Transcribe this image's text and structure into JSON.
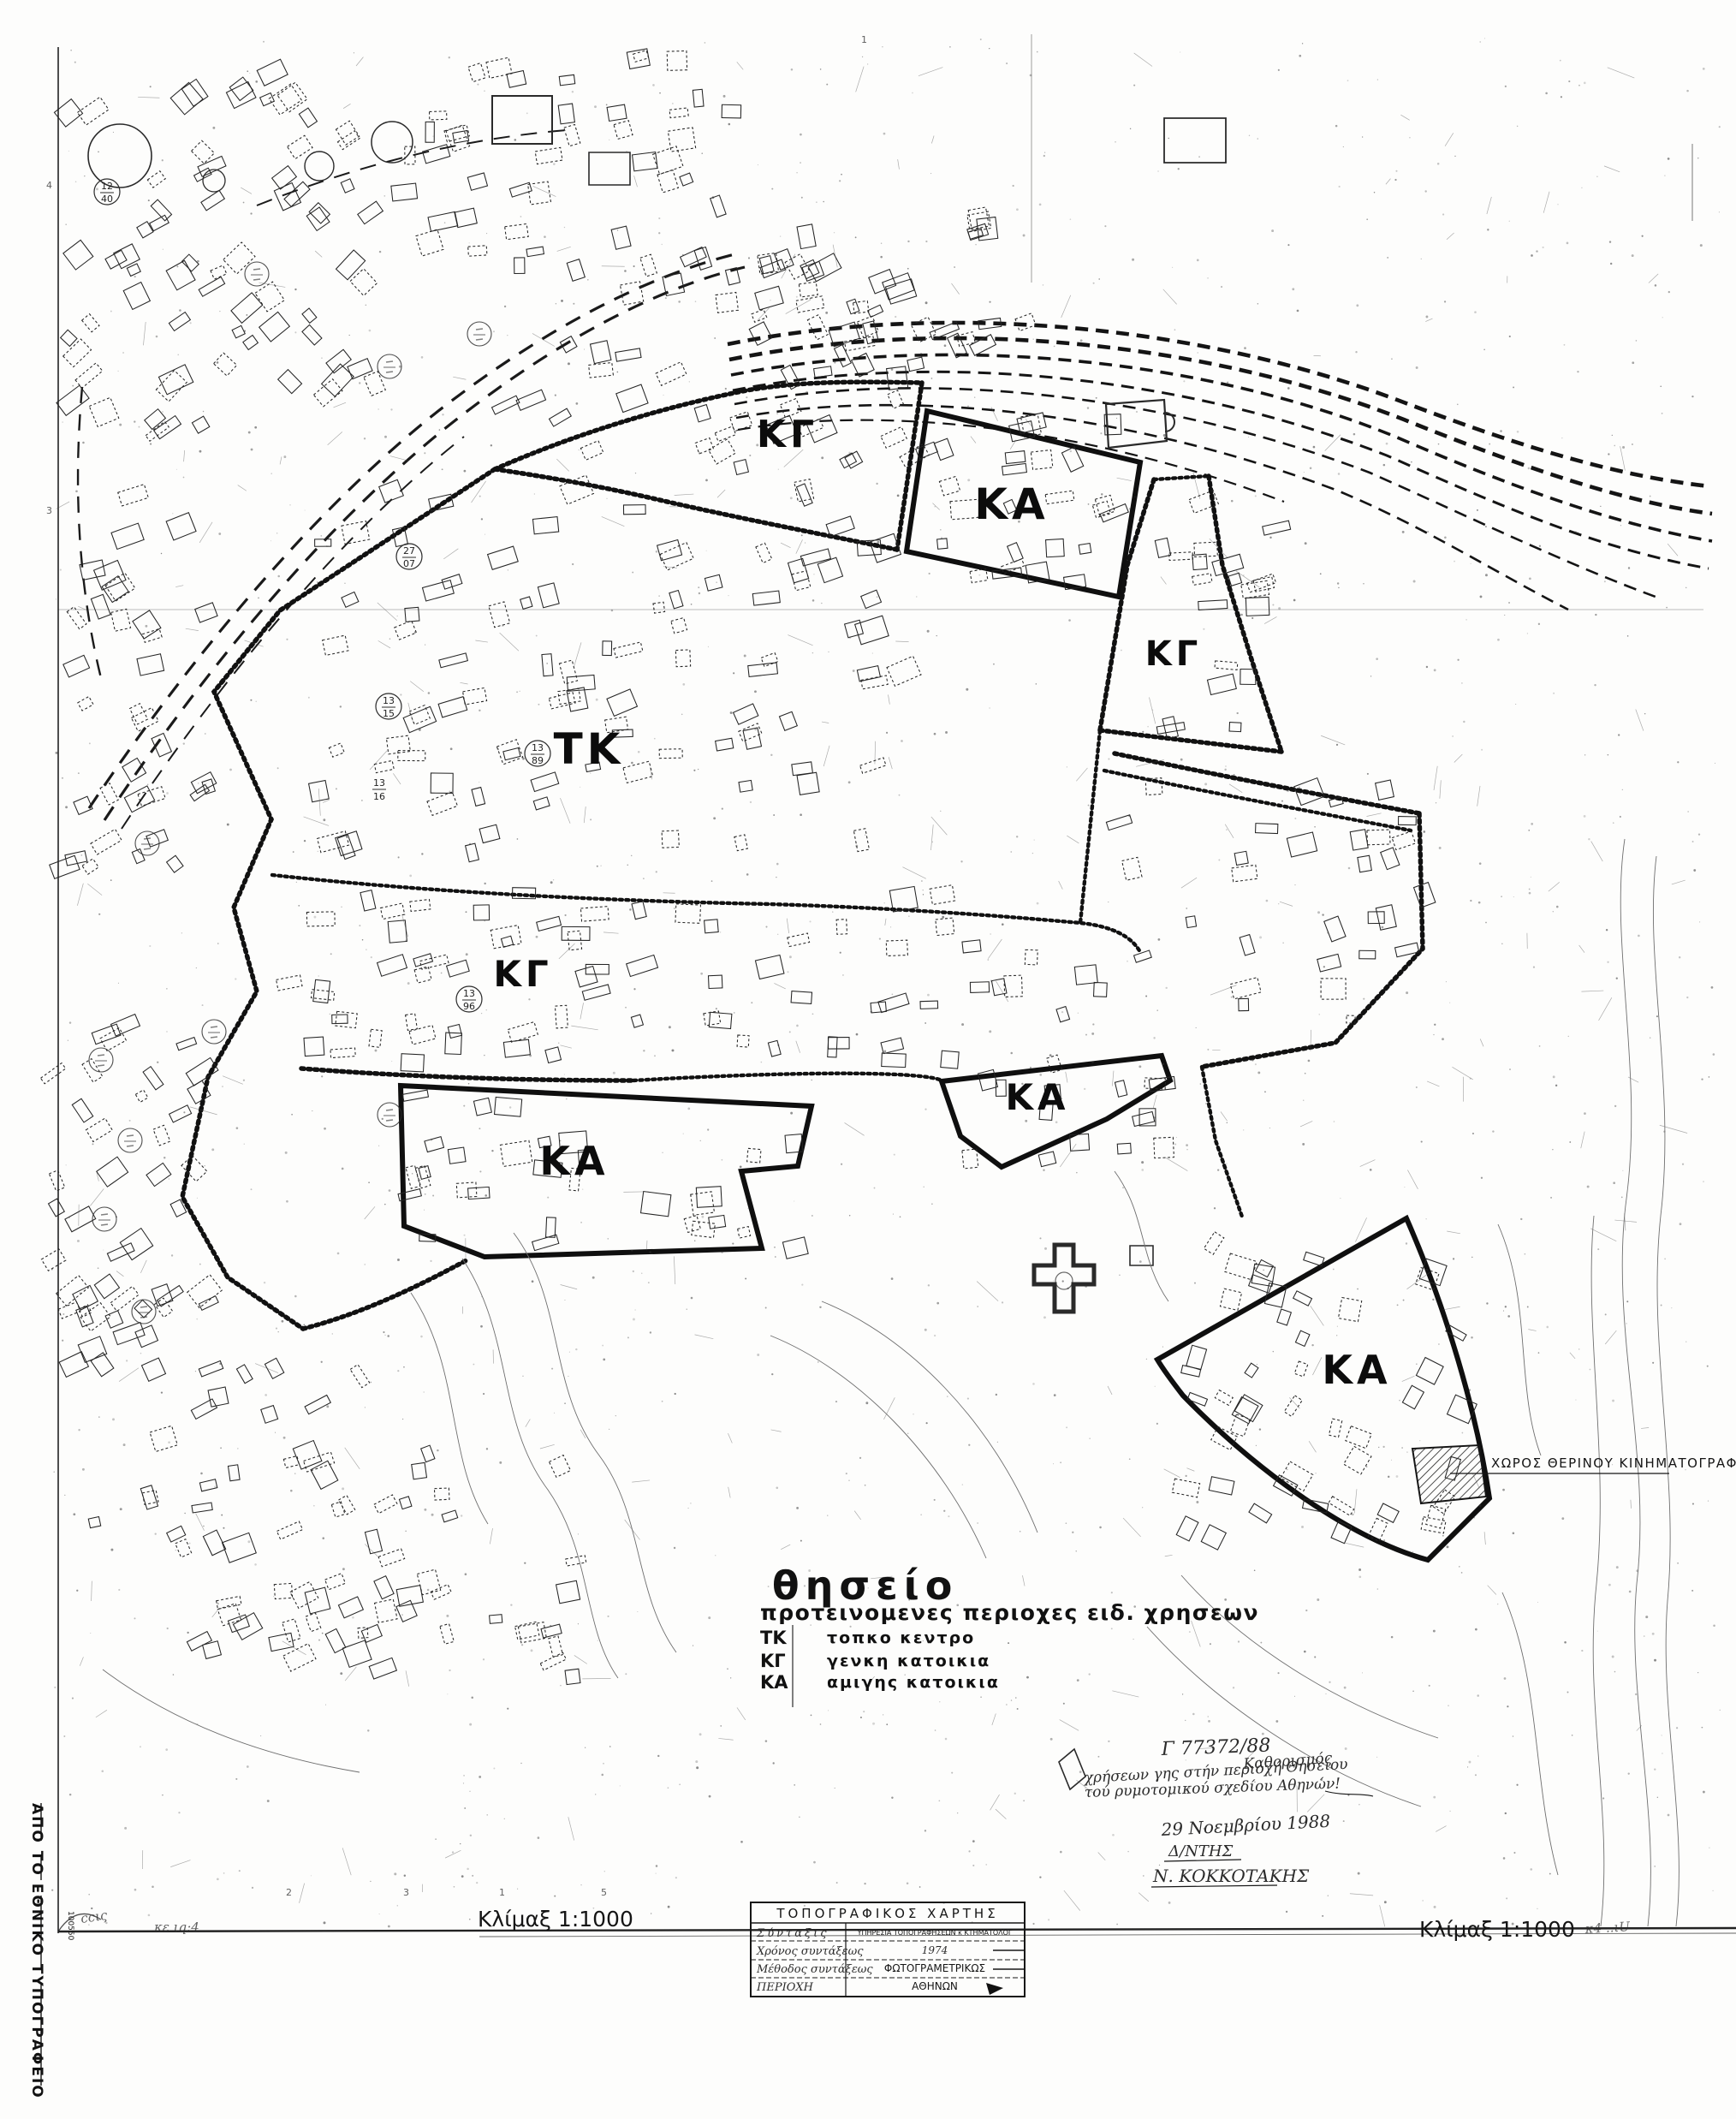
{
  "sheet": {
    "margin_vertical_text": "ΑΠΟ ΤΟ ΕΘΝΙΚΟ ΤΥΠΟΓΡΑΦΕΙΟ",
    "sheet_code_vertical": "100550",
    "grid_digits_bottom": [
      "2",
      "3",
      "1",
      "5"
    ],
    "grid_digits_left": [
      "4",
      "3"
    ],
    "top_tick": "1"
  },
  "legend": {
    "title": "θησείο",
    "subtitle": "προτεινομενες περιοχες ειδ. χρησεων",
    "entries": [
      {
        "code": "ΤΚ",
        "label": "τοπκο κεντρο"
      },
      {
        "code": "ΚΓ",
        "label": "γενκη κατοικια"
      },
      {
        "code": "ΚΑ",
        "label": "αμιγης κατοικια"
      }
    ]
  },
  "map": {
    "zone_labels": [
      {
        "text": "ΚΓ"
      },
      {
        "text": "ΚΑ"
      },
      {
        "text": "ΚΓ"
      },
      {
        "text": "ΤΚ"
      },
      {
        "text": "ΚΓ"
      },
      {
        "text": "ΚΑ"
      },
      {
        "text": "ΚΑ"
      },
      {
        "text": "ΚΑ"
      }
    ],
    "cinema_label": "ΧΩΡΟΣ ΘΕΡΙΝΟΥ ΚΙΝΗΜΑΤΟΓΡΑΦΟΥ",
    "block_markers": [
      {
        "top": "12",
        "bottom": "40"
      },
      {
        "top": "27",
        "bottom": "07"
      },
      {
        "top": "13",
        "bottom": "15"
      },
      {
        "top": "13",
        "bottom": "96"
      },
      {
        "top": "13",
        "bottom": "89"
      },
      {
        "top": "13",
        "bottom": "16"
      }
    ]
  },
  "handwritten": {
    "ref_number": "Γ 77372/88",
    "note_word": "Καθορισμός",
    "note_line1": "χρήσεων γης στήν περιοχή Θησείου",
    "note_line2": "τού ρυμοτομικού σχεδίου Αθηνών!",
    "date": "29 Νοεμβρίου 1988",
    "role": "Δ/ΝΤΗΣ",
    "signature": "Ν. ΚΟΚΚΟΤΑΚΗΣ",
    "margin_left_a": "ccις",
    "margin_left_b": "κε ιq:4",
    "margin_right": "κ4 ..ιU"
  },
  "scales": {
    "left": "Κλίμαξ 1:1000",
    "right": "Κλίμαξ 1:1000"
  },
  "title_block": {
    "title": "ΤΟΠΟΓΡΑΦΙΚΟΣ ΧΑΡΤΗΣ",
    "rows": [
      {
        "label": "Σύνταξις",
        "value": "ΥΠΗΡΕΣΙΑ ΤΟΠΟΓΡΑΦΗΣΕΩΝ κ ΚΤΗΜΑΤΟΛΟΓ"
      },
      {
        "label": "Χρόνος συντάξεως",
        "value": "1974"
      },
      {
        "label": "Μέθοδος συντάξεως",
        "value": "ΦΩΤΟΓΡΑΜΕΤΡΙΚΩΣ"
      },
      {
        "label": "ΠΕΡΙΟΧΗ",
        "value": "ΑΘΗΝΩΝ"
      }
    ]
  }
}
